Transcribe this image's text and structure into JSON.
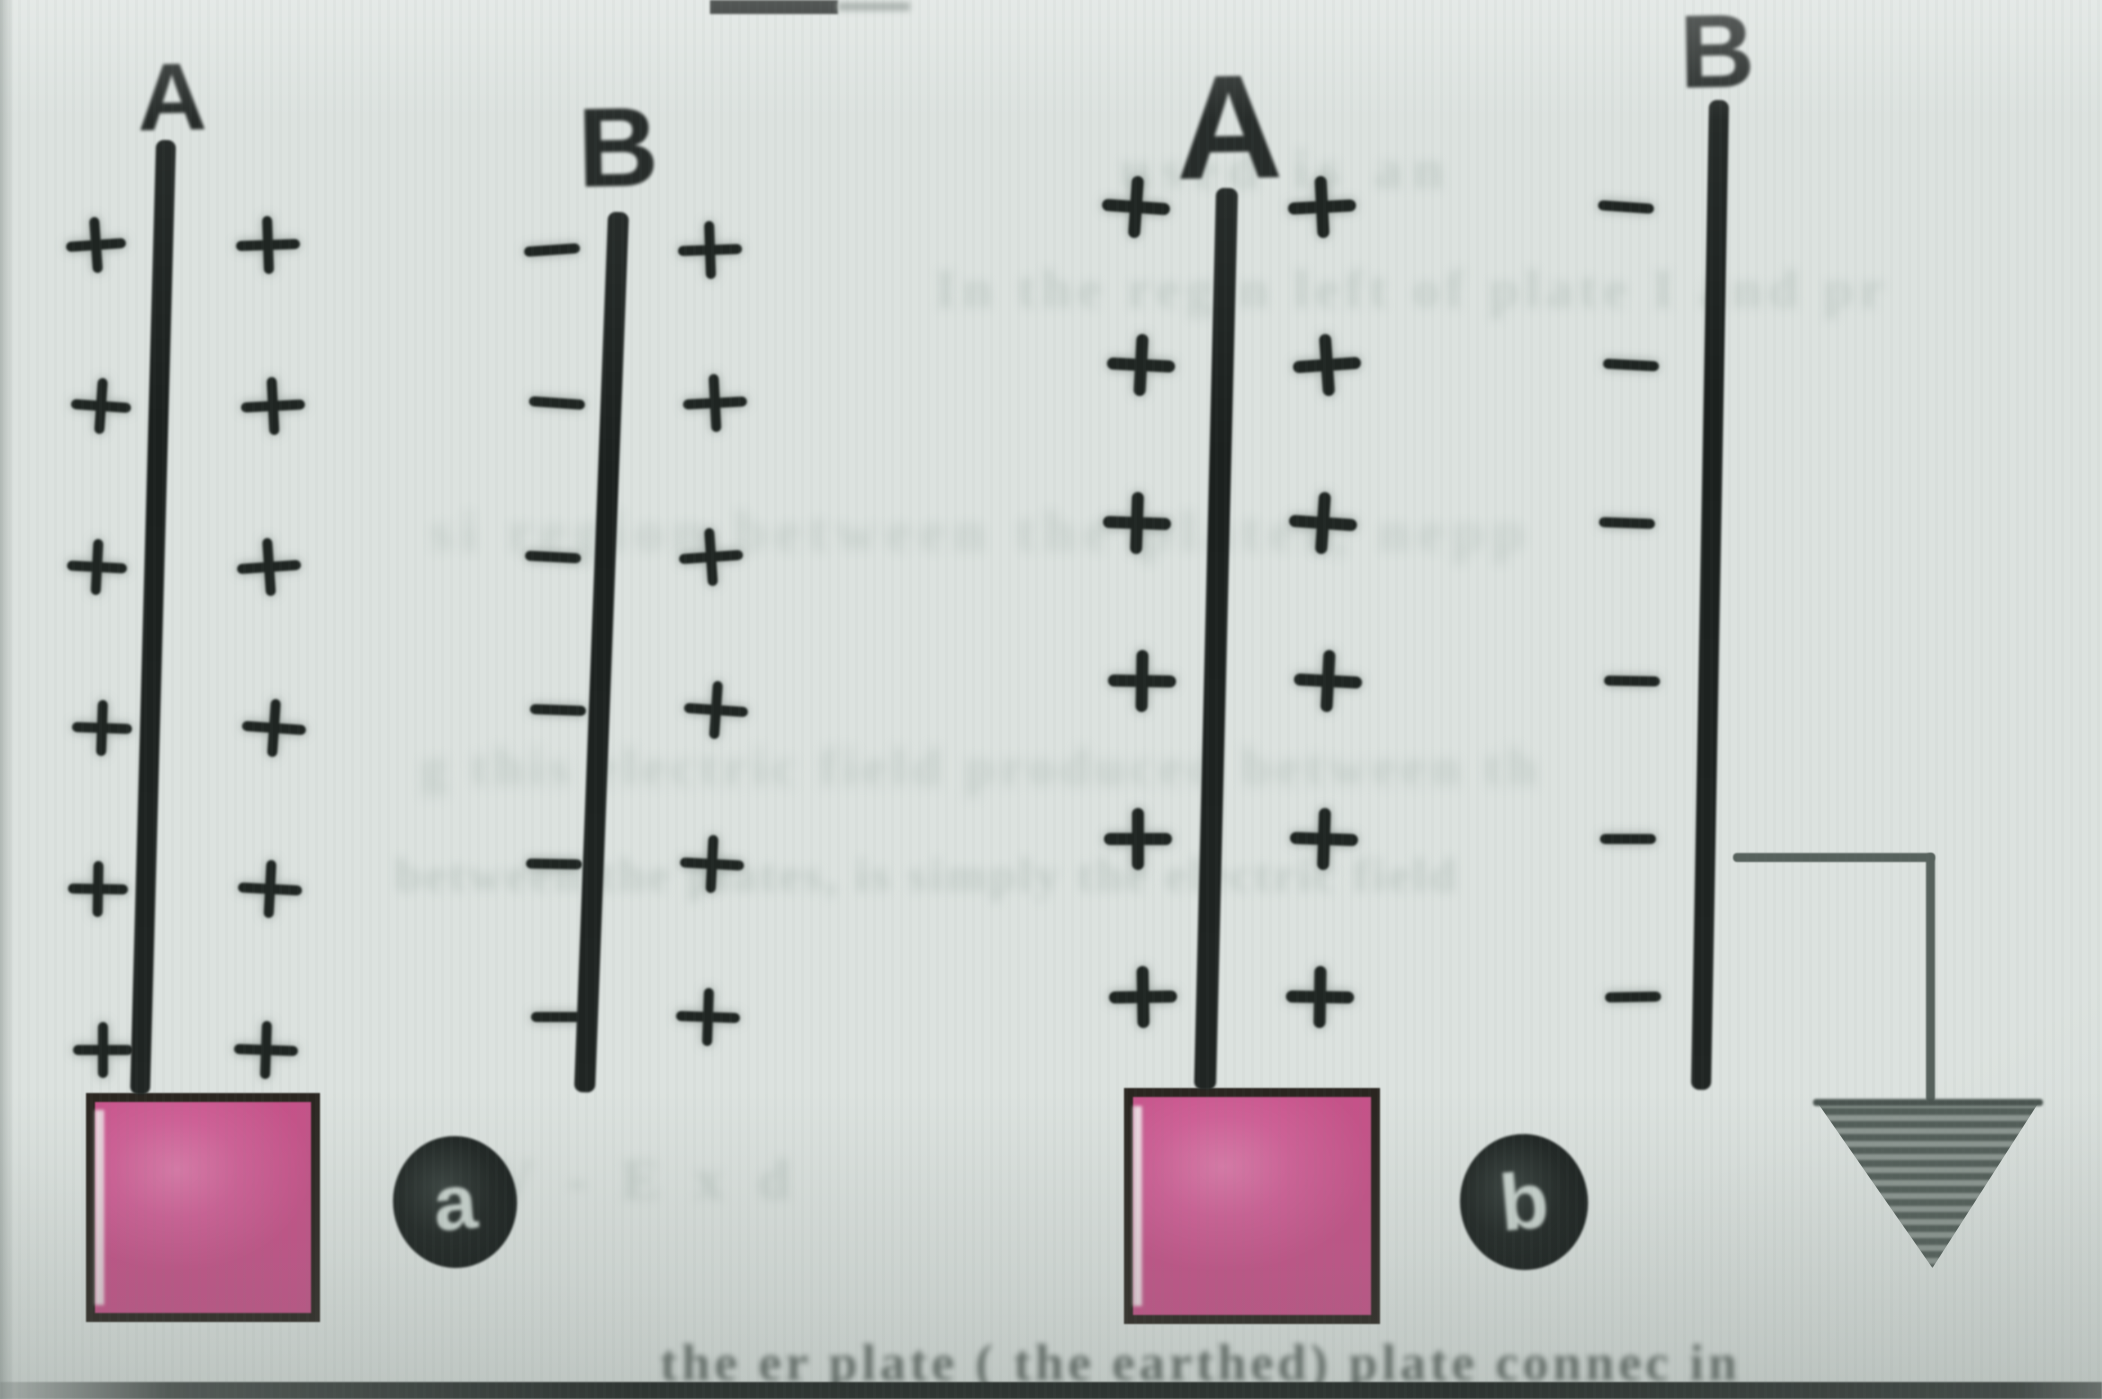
{
  "page": {
    "width": 2102,
    "height": 1399,
    "colors": {
      "background": "#dce2df",
      "ink": "#202523",
      "charge_ink": "#1f2522",
      "stand_pink": "#d06097",
      "stand_outline": "#2a2520",
      "badge_background": "#171c1b",
      "badge_text": "#c9d3ce",
      "wire_gray": "#56615c",
      "bleedthrough_text": "#aebbb5"
    }
  },
  "top_rule": {
    "x": 710,
    "y": 0,
    "w": 128,
    "h": 14,
    "smudge_x": 838,
    "smudge_w": 72
  },
  "bottom_rule": {
    "y": 1382,
    "h": 17
  },
  "figures": [
    {
      "id": "a",
      "badge": {
        "label": "a",
        "cx": 455,
        "cy": 1202,
        "rx": 62,
        "ry": 66,
        "font": 78
      },
      "stand": {
        "x": 86,
        "y": 1093,
        "w": 234,
        "h": 229
      },
      "plates": [
        {
          "label": "A",
          "label_cx": 172,
          "label_cy": 98,
          "label_font": 96,
          "line": {
            "x_top": 166,
            "y_top": 140,
            "x_bottom": 192,
            "y_bottom": 1095,
            "w": 20
          },
          "arrowhead": {
            "apex_x": 167,
            "apex_y": 98,
            "half_w": 22,
            "h": 46
          },
          "columns": [
            {
              "symbol": "plus",
              "x": 100,
              "size": 60,
              "rows": [
                245,
                406,
                567,
                728,
                889,
                1050
              ]
            },
            {
              "symbol": "plus",
              "x": 270,
              "size": 64,
              "rows": [
                245,
                406,
                567,
                728,
                889,
                1050
              ]
            }
          ]
        },
        {
          "label": "B",
          "label_cx": 618,
          "label_cy": 148,
          "label_font": 112,
          "line": {
            "x_top": 618,
            "y_top": 212,
            "x_bottom": 652,
            "y_bottom": 1092,
            "w": 21
          },
          "arrowhead": null,
          "columns": [
            {
              "symbol": "minus",
              "x": 556,
              "size": 56,
              "rows": [
                250,
                403,
                557,
                710,
                864,
                1017
              ]
            },
            {
              "symbol": "plus",
              "x": 712,
              "size": 64,
              "rows": [
                250,
                403,
                557,
                710,
                864,
                1017
              ]
            }
          ]
        }
      ]
    },
    {
      "id": "b",
      "badge": {
        "label": "b",
        "cx": 1524,
        "cy": 1202,
        "rx": 64,
        "ry": 68,
        "font": 80
      },
      "stand": {
        "x": 1124,
        "y": 1088,
        "w": 256,
        "h": 236
      },
      "plates": [
        {
          "label": "A",
          "label_cx": 1229,
          "label_cy": 128,
          "label_font": 148,
          "line": {
            "x_top": 1227,
            "y_top": 188,
            "x_bottom": 1249,
            "y_bottom": 1090,
            "w": 22
          },
          "arrowhead": {
            "apex_x": 1228,
            "apex_y": 148,
            "half_w": 24,
            "h": 58
          },
          "columns": [
            {
              "symbol": "plus",
              "x": 1140,
              "size": 68,
              "rows": [
                207,
                365,
                523,
                681,
                839,
                997
              ]
            },
            {
              "symbol": "plus",
              "x": 1324,
              "size": 68,
              "rows": [
                207,
                365,
                523,
                681,
                839,
                997
              ]
            }
          ]
        },
        {
          "label": "B",
          "label_cx": 1717,
          "label_cy": 52,
          "label_font": 104,
          "line": {
            "x_top": 1719,
            "y_top": 100,
            "x_bottom": 1737,
            "y_bottom": 1090,
            "w": 20
          },
          "arrowhead": null,
          "columns": [
            {
              "symbol": "minus",
              "x": 1630,
              "size": 56,
              "rows": [
                207,
                365,
                523,
                681,
                839,
                997
              ]
            }
          ]
        }
      ]
    }
  ],
  "earth": {
    "wire": {
      "from_x": 1733,
      "y": 853,
      "corner_x": 1926,
      "down_to_y": 1102,
      "thickness": 9
    },
    "triangle": {
      "x": 1817,
      "y": 1102,
      "w": 222,
      "h": 166
    }
  },
  "bleedthrough": [
    {
      "text": "used is an",
      "x": 1120,
      "y": 138,
      "fs": 56,
      "o": 0.5,
      "blur": 5,
      "ls": 10,
      "dark": false
    },
    {
      "text": "In the reg    n left of plate I and pr",
      "x": 935,
      "y": 258,
      "fs": 54,
      "o": 0.5,
      "blur": 5,
      "ls": 6,
      "dark": false
    },
    {
      "text": "si region between the plates, nepp",
      "x": 430,
      "y": 498,
      "fs": 58,
      "o": 0.45,
      "blur": 6,
      "ls": 8,
      "dark": false
    },
    {
      "text": "g this electric field produced between th",
      "x": 420,
      "y": 736,
      "fs": 54,
      "o": 0.5,
      "blur": 6,
      "ls": 5,
      "dark": false
    },
    {
      "text": "between the plates, is simply the electric field",
      "x": 395,
      "y": 848,
      "fs": 48,
      "o": 0.55,
      "blur": 5,
      "ls": 3,
      "dark": false
    },
    {
      "text": "V - E x d",
      "x": 492,
      "y": 1146,
      "fs": 58,
      "o": 0.5,
      "blur": 5,
      "ls": 10,
      "dark": false
    },
    {
      "text": "the   er plate ( the earthed) plate connec    in",
      "x": 660,
      "y": 1334,
      "fs": 52,
      "o": 0.75,
      "blur": 3,
      "ls": 4,
      "dark": true
    }
  ]
}
